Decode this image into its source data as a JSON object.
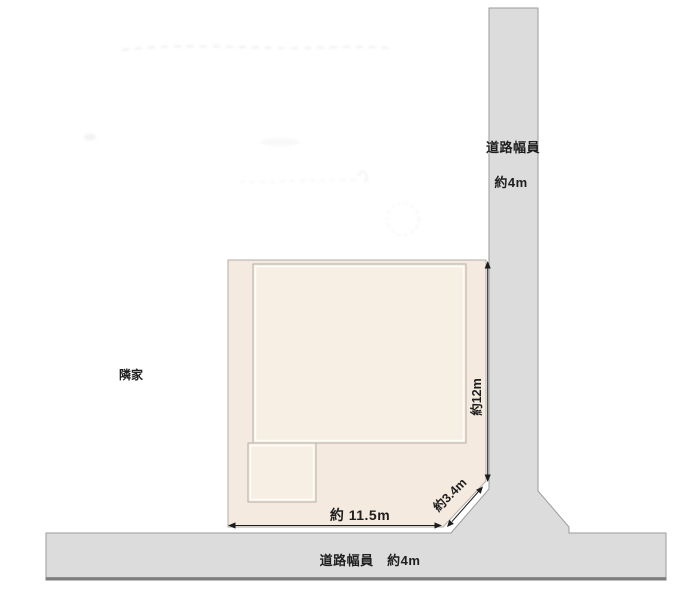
{
  "labels": {
    "right_road_name": "道路幅員",
    "right_road_width": "約4m",
    "bottom_road": "道路幅員　約4m",
    "dim_width": "約 11.5m",
    "dim_depth": "約12m",
    "dim_chamfer": "約3.4m",
    "neighbor": "隣家"
  },
  "colors": {
    "road_fill": "#dcdcdc",
    "road_border": "#9a9a9a",
    "road_bottom_edge": "#7e7e7e",
    "plot_fill": "#f5eadf",
    "plot_border": "#b3aea6",
    "building_fill": "#f7eee4",
    "arrow": "#1c1c1c"
  }
}
